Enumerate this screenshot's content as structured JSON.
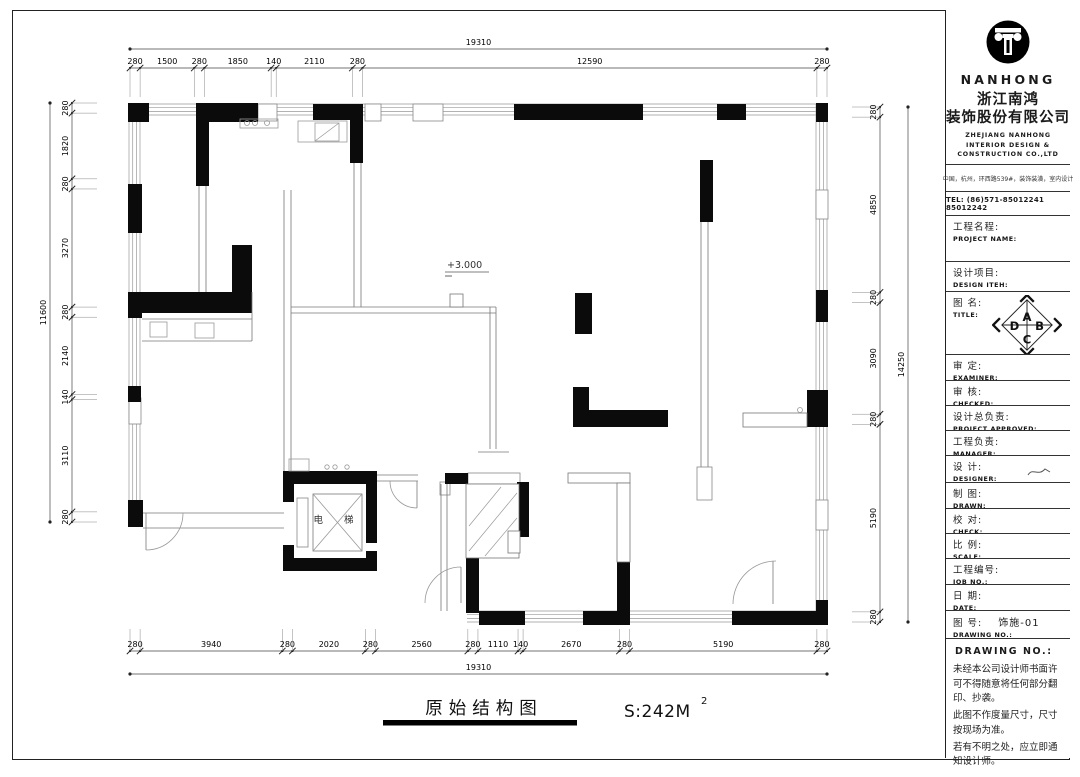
{
  "drawing": {
    "title": "原始结构图",
    "area_label": "S:242M",
    "area_sup": "2",
    "level_marker": "+3.000",
    "elevator_label": "电 梯"
  },
  "dimensions": {
    "top": {
      "overall": "19310",
      "segments": [
        "280",
        "1500",
        "280",
        "1850",
        "140",
        "2110",
        "280",
        "12590",
        "280"
      ]
    },
    "bottom": {
      "overall": "19310",
      "segments": [
        "280",
        "3940",
        "280",
        "2020",
        "280",
        "2560",
        "280",
        "1110",
        "140",
        "2670",
        "280",
        "5190",
        "280"
      ]
    },
    "left": {
      "overall": "11600",
      "segments": [
        "280",
        "1820",
        "280",
        "3270",
        "280",
        "2140",
        "140",
        "3110",
        "280"
      ]
    },
    "right": {
      "overall": "14250",
      "segments": [
        "280",
        "4850",
        "280",
        "3090",
        "280",
        "5190",
        "280"
      ]
    }
  },
  "title_block": {
    "wordmark": "NANHONG",
    "company_cn_1": "浙江南鸿",
    "company_cn_2": "装饰股份有限公司",
    "company_en_1": "ZHEJIANG NANHONG",
    "company_en_2": "INTERIOR DESIGN &",
    "company_en_3": "CONSTRUCTION CO.,LTD",
    "address": "中国，杭州，环西路539#，装饰装潢，室内设计",
    "tel": "TEL: (86)571-85012241 85012242",
    "fields": [
      {
        "id": "project-name",
        "cn": "工程名程:",
        "en": "PROJECT NAME:",
        "value": ""
      },
      {
        "id": "design-item",
        "cn": "设计项目:",
        "en": "DESIGN ITEH:",
        "value": ""
      },
      {
        "id": "title",
        "cn": "图 名:",
        "en": "TITLE:",
        "value": ""
      },
      {
        "id": "examiner",
        "cn": "审 定:",
        "en": "EXAMINER:",
        "value": ""
      },
      {
        "id": "checked",
        "cn": "审 核:",
        "en": "CHECKED:",
        "value": ""
      },
      {
        "id": "approved",
        "cn": "设计总负责:",
        "en": "PROJECT APPROVED:",
        "value": ""
      },
      {
        "id": "manager",
        "cn": "工程负责:",
        "en": "MANAGER:",
        "value": ""
      },
      {
        "id": "designer",
        "cn": "设 计:",
        "en": "DESIGNER:",
        "value": ""
      },
      {
        "id": "drawn",
        "cn": "制 图:",
        "en": "DRAWN:",
        "value": ""
      },
      {
        "id": "check",
        "cn": "校 对:",
        "en": "CHECK:",
        "value": ""
      },
      {
        "id": "scale",
        "cn": "比 例:",
        "en": "SCALE:",
        "value": ""
      },
      {
        "id": "job-no",
        "cn": "工程编号:",
        "en": "JOB NO.:",
        "value": ""
      },
      {
        "id": "date",
        "cn": "日 期:",
        "en": "DATE:",
        "value": ""
      },
      {
        "id": "drawing-no",
        "cn": "图 号:",
        "en": "DRAWING NO.:",
        "value": "饰施-01"
      }
    ],
    "compass": {
      "top": "A",
      "right": "B",
      "bottom": "C",
      "left": "D"
    },
    "notes_header": "DRAWING NO.:",
    "notes": [
      "未经本公司设计师书面许可不得随意将任何部分翻印、抄袭。",
      "此图不作度量尺寸，尺寸按现场为准。",
      "若有不明之处，应立即通知设计师。"
    ]
  }
}
